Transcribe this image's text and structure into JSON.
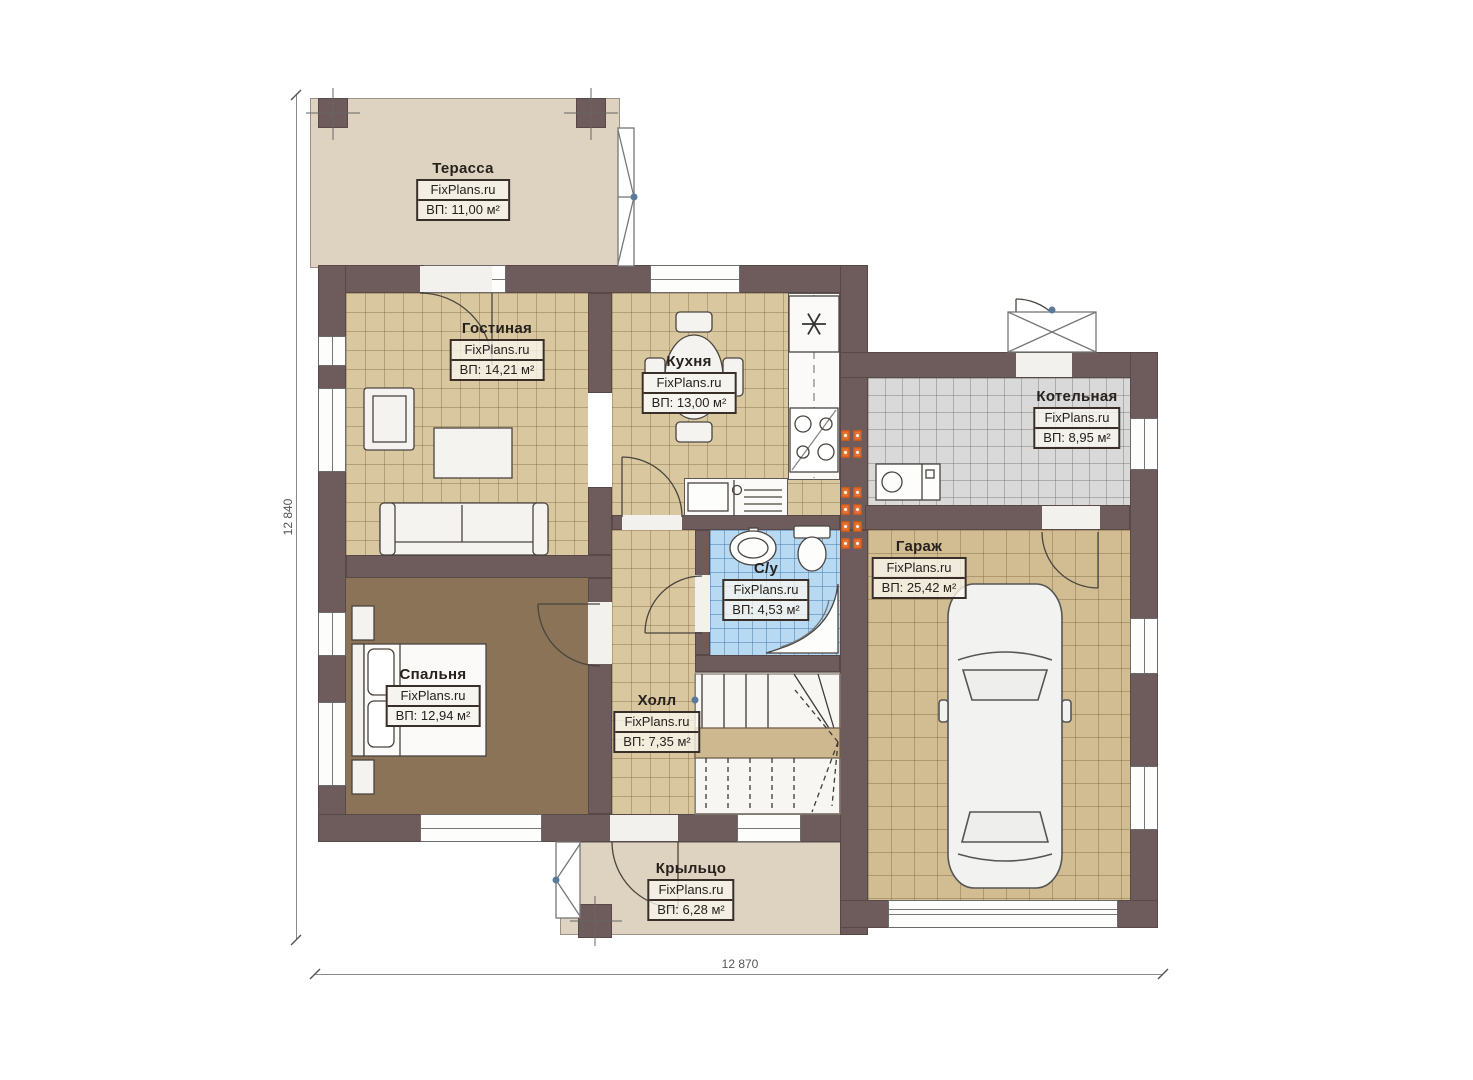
{
  "watermark": "FixPlans.ru",
  "dimensions": {
    "height_label": "12 840",
    "width_label": "12 870"
  },
  "rooms": [
    {
      "id": "terrace",
      "label": "Терасса",
      "area": "ВП: 11,00 м²"
    },
    {
      "id": "living",
      "label": "Гостиная",
      "area": "ВП: 14,21 м²"
    },
    {
      "id": "kitchen",
      "label": "Кухня",
      "area": "ВП: 13,00 м²"
    },
    {
      "id": "boiler",
      "label": "Котельная",
      "area": "ВП: 8,95 м²"
    },
    {
      "id": "garage",
      "label": "Гараж",
      "area": "ВП: 25,42 м²"
    },
    {
      "id": "bedroom",
      "label": "Спальня",
      "area": "ВП: 12,94 м²"
    },
    {
      "id": "bathroom",
      "label": "С/у",
      "area": "ВП: 4,53 м²"
    },
    {
      "id": "hall",
      "label": "Холл",
      "area": "ВП: 7,35 м²"
    },
    {
      "id": "porch",
      "label": "Крыльцо",
      "area": "ВП: 6,28 м²"
    }
  ],
  "colors": {
    "wall": "#6e5b5b",
    "floor_tile": "#d8c79f",
    "floor_wood": "#8a7357",
    "tile_grey": "#d9d9d9",
    "tile_blue": "#b7d9f2",
    "terrace_floor": "#ded3c0",
    "radiator": "#e97132"
  }
}
